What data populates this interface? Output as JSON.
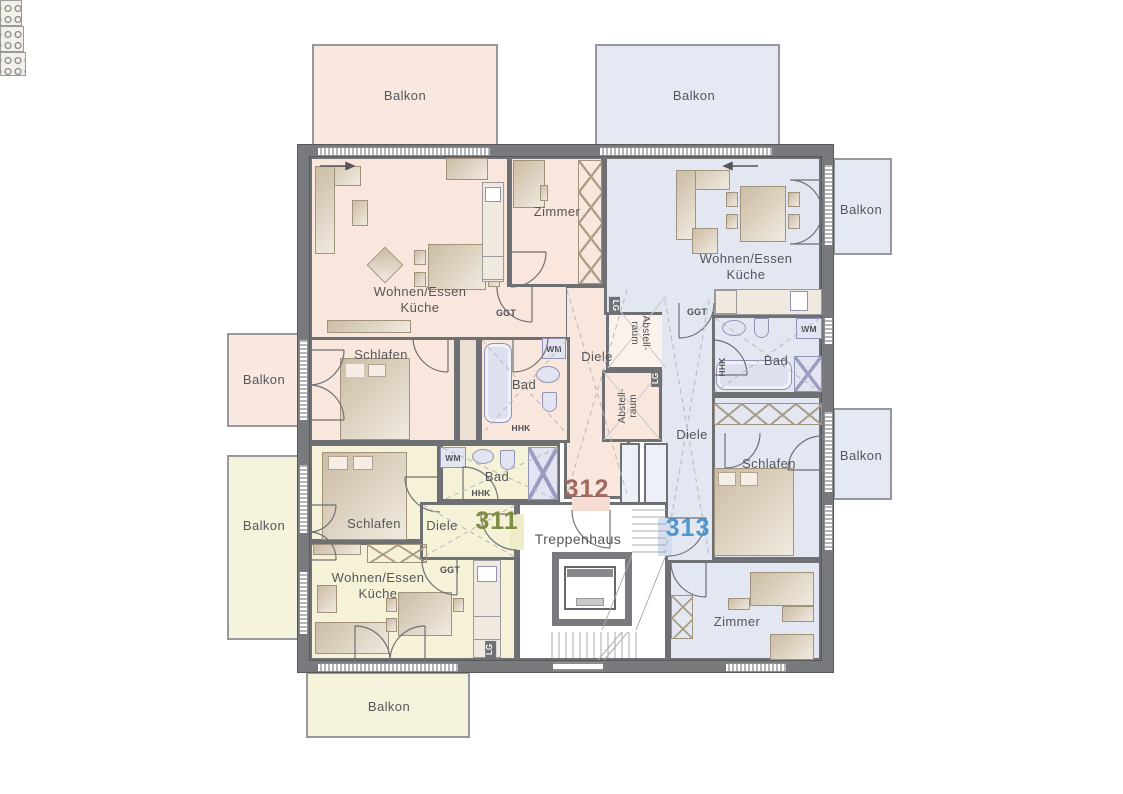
{
  "floorplan": {
    "apartments": [
      {
        "number": "311",
        "accent_color": "#7d8c3f",
        "fill_color": "#f5f2d8",
        "rooms": [
          "Wohnen/Essen Küche",
          "Schlafen",
          "Bad",
          "Diele",
          "Balkon"
        ]
      },
      {
        "number": "312",
        "accent_color": "#a0685f",
        "fill_color": "#f9e7de",
        "rooms": [
          "Wohnen/Essen Küche",
          "Zimmer",
          "Schlafen",
          "Bad",
          "Diele",
          "Abstellraum",
          "Balkon"
        ]
      },
      {
        "number": "313",
        "accent_color": "#4e97d1",
        "fill_color": "#e2e7f2",
        "rooms": [
          "Wohnen/Essen Küche",
          "Schlafen",
          "Zimmer",
          "Bad",
          "Diele",
          "Abstellraum",
          "Balkon"
        ]
      }
    ],
    "shared_areas": [
      "Treppenhaus"
    ],
    "wall_color": "#6f7073"
  },
  "labels": {
    "balkon": "Balkon",
    "wohnen_essen": "Wohnen/Essen",
    "kueche": "Küche",
    "schlafen": "Schlafen",
    "zimmer": "Zimmer",
    "bad": "Bad",
    "diele": "Diele",
    "treppenhaus": "Treppenhaus",
    "abstell_line1": "Abstell-",
    "abstell_line2": "raum",
    "ggt": "GGT",
    "wm": "WM",
    "hhk": "HHK",
    "lg": "LG"
  }
}
